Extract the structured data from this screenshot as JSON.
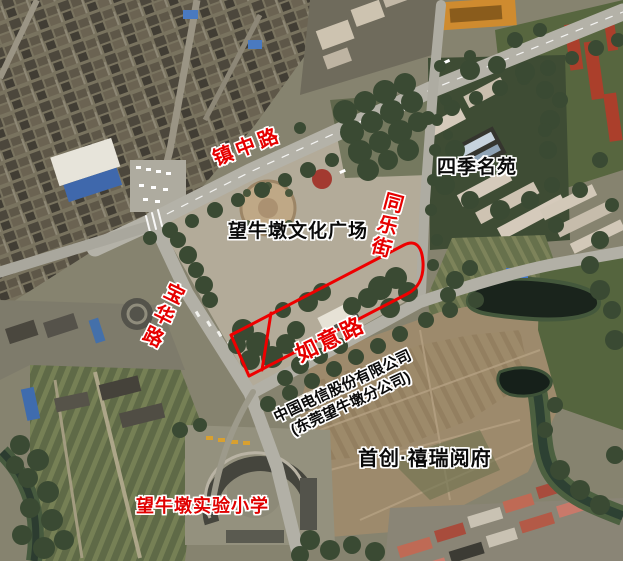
{
  "map": {
    "kind": "satellite-imagery-with-annotations",
    "labels": {
      "zhenzhong_road": "镇中路",
      "tongle_street": "同乐街",
      "baohua_road": "宝华路",
      "ruyi_road": "如意路",
      "siji_mingyuan": "四季名苑",
      "wangniudun_cultural_plaza": "望牛墩文化广场",
      "telecom_line1": "中国电信股份有限公司",
      "telecom_line2": "(东莞望牛墩分公司)",
      "shouchuang_xirui": "首创·禧瑞阅府",
      "wangniudun_primary_school": "望牛墩实验小学"
    },
    "colors": {
      "road_label_red": "#e60000",
      "place_label_black": "#0a0a0a",
      "school_label_red": "#e00000",
      "parcel_outline_red": "#ee0000"
    }
  }
}
